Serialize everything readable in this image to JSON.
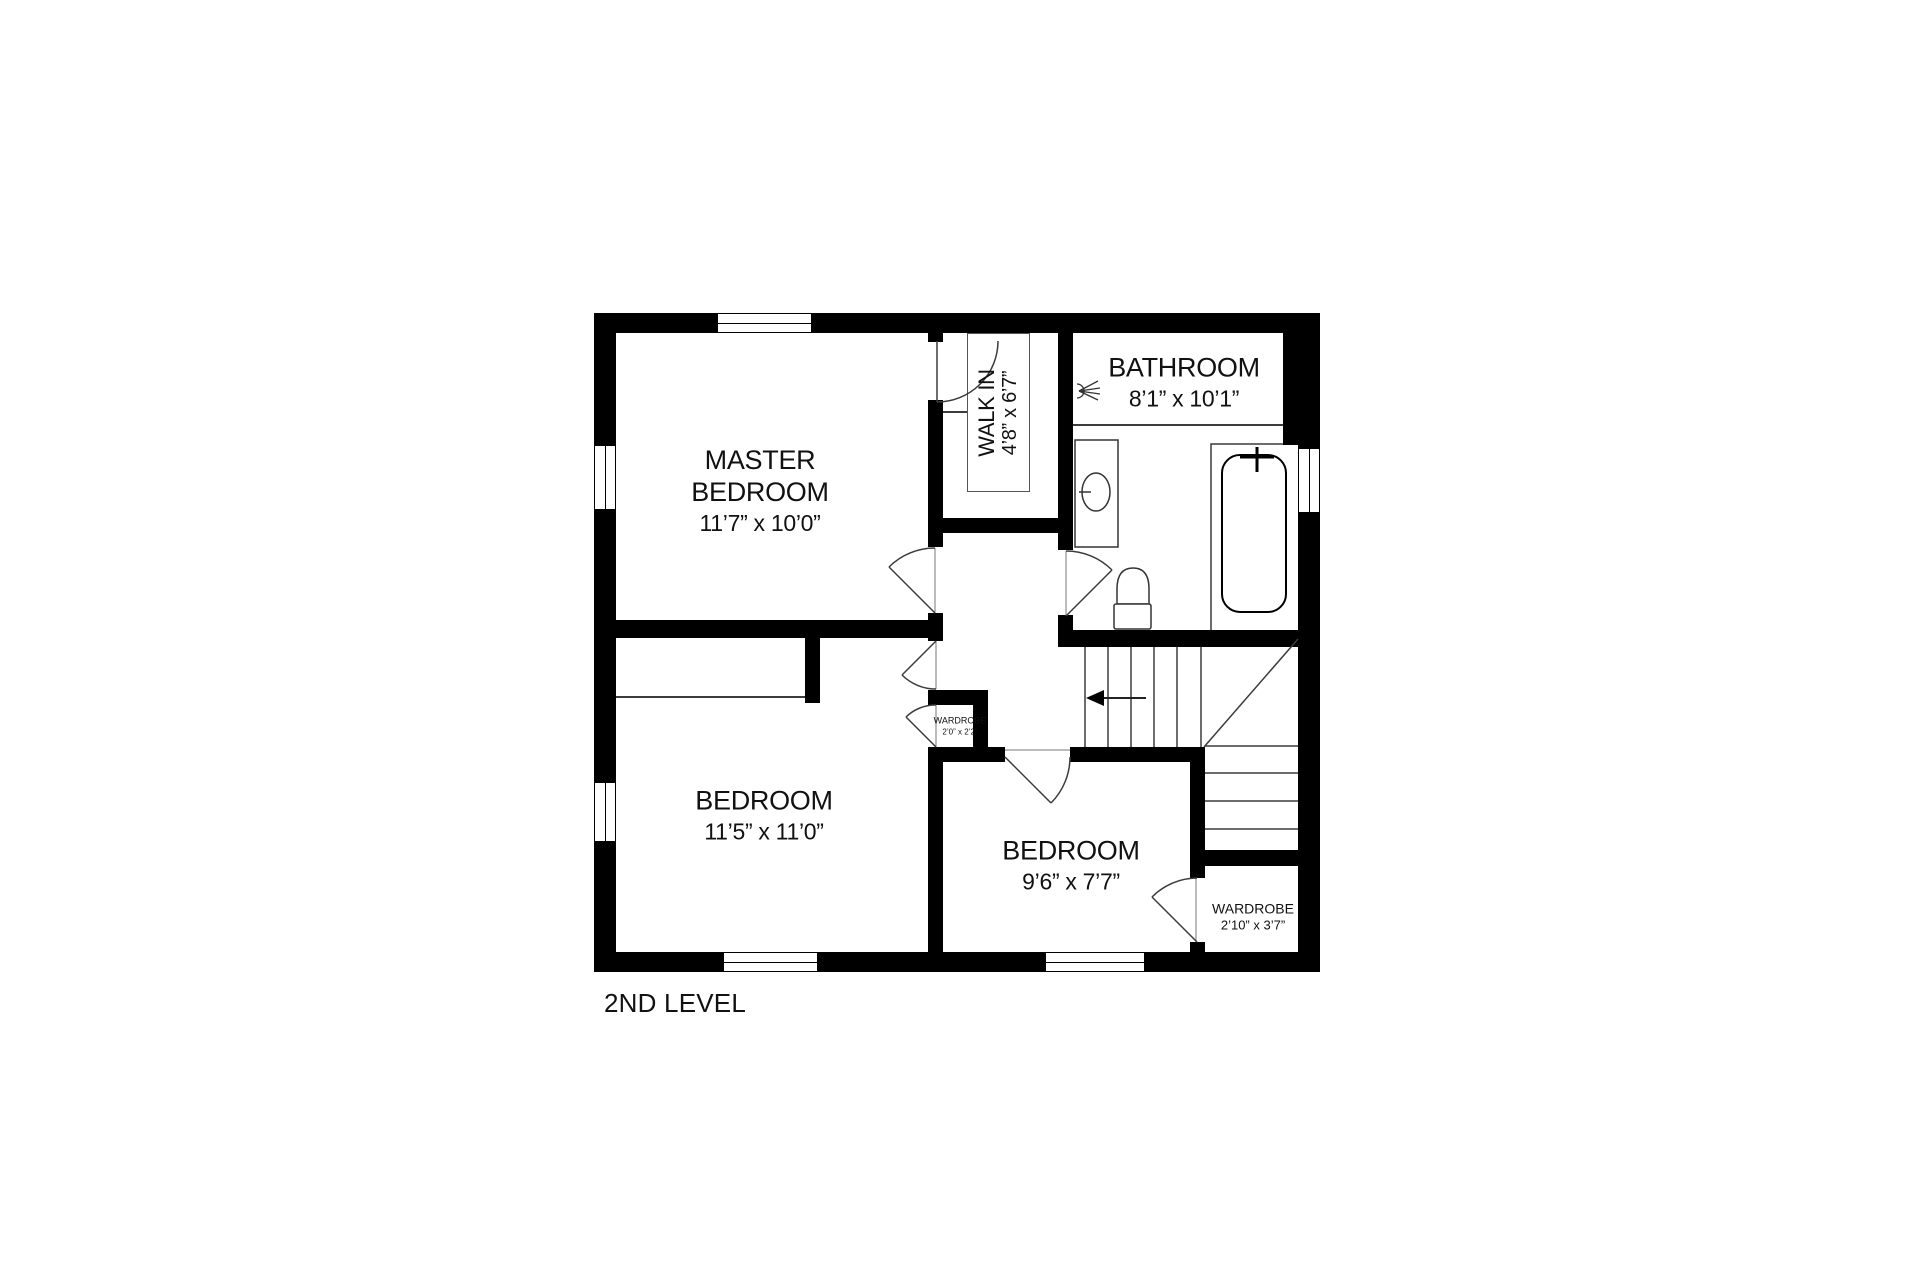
{
  "title": "2ND LEVEL",
  "rooms": {
    "master_bedroom": {
      "name": "MASTER BEDROOM",
      "dims": "11’7” x 10’0”"
    },
    "walk_in": {
      "name": "WALK IN",
      "dims": "4’8” x 6’7”"
    },
    "bathroom": {
      "name": "BATHROOM",
      "dims": "8’1” x 10’1”"
    },
    "bedroom_left": {
      "name": "BEDROOM",
      "dims": "11’5” x 11’0”"
    },
    "bedroom_right": {
      "name": "BEDROOM",
      "dims": "9’6” x 7’7”"
    },
    "wardrobe_small": {
      "name": "WARDROBE",
      "dims": "2’0” x 2’2”"
    },
    "wardrobe_large": {
      "name": "WARDROBE",
      "dims": "2’10” x 3’7”"
    }
  },
  "colors": {
    "wall": "#000000",
    "line": "#3c3c3c",
    "text": "#111111",
    "background": "#ffffff"
  }
}
